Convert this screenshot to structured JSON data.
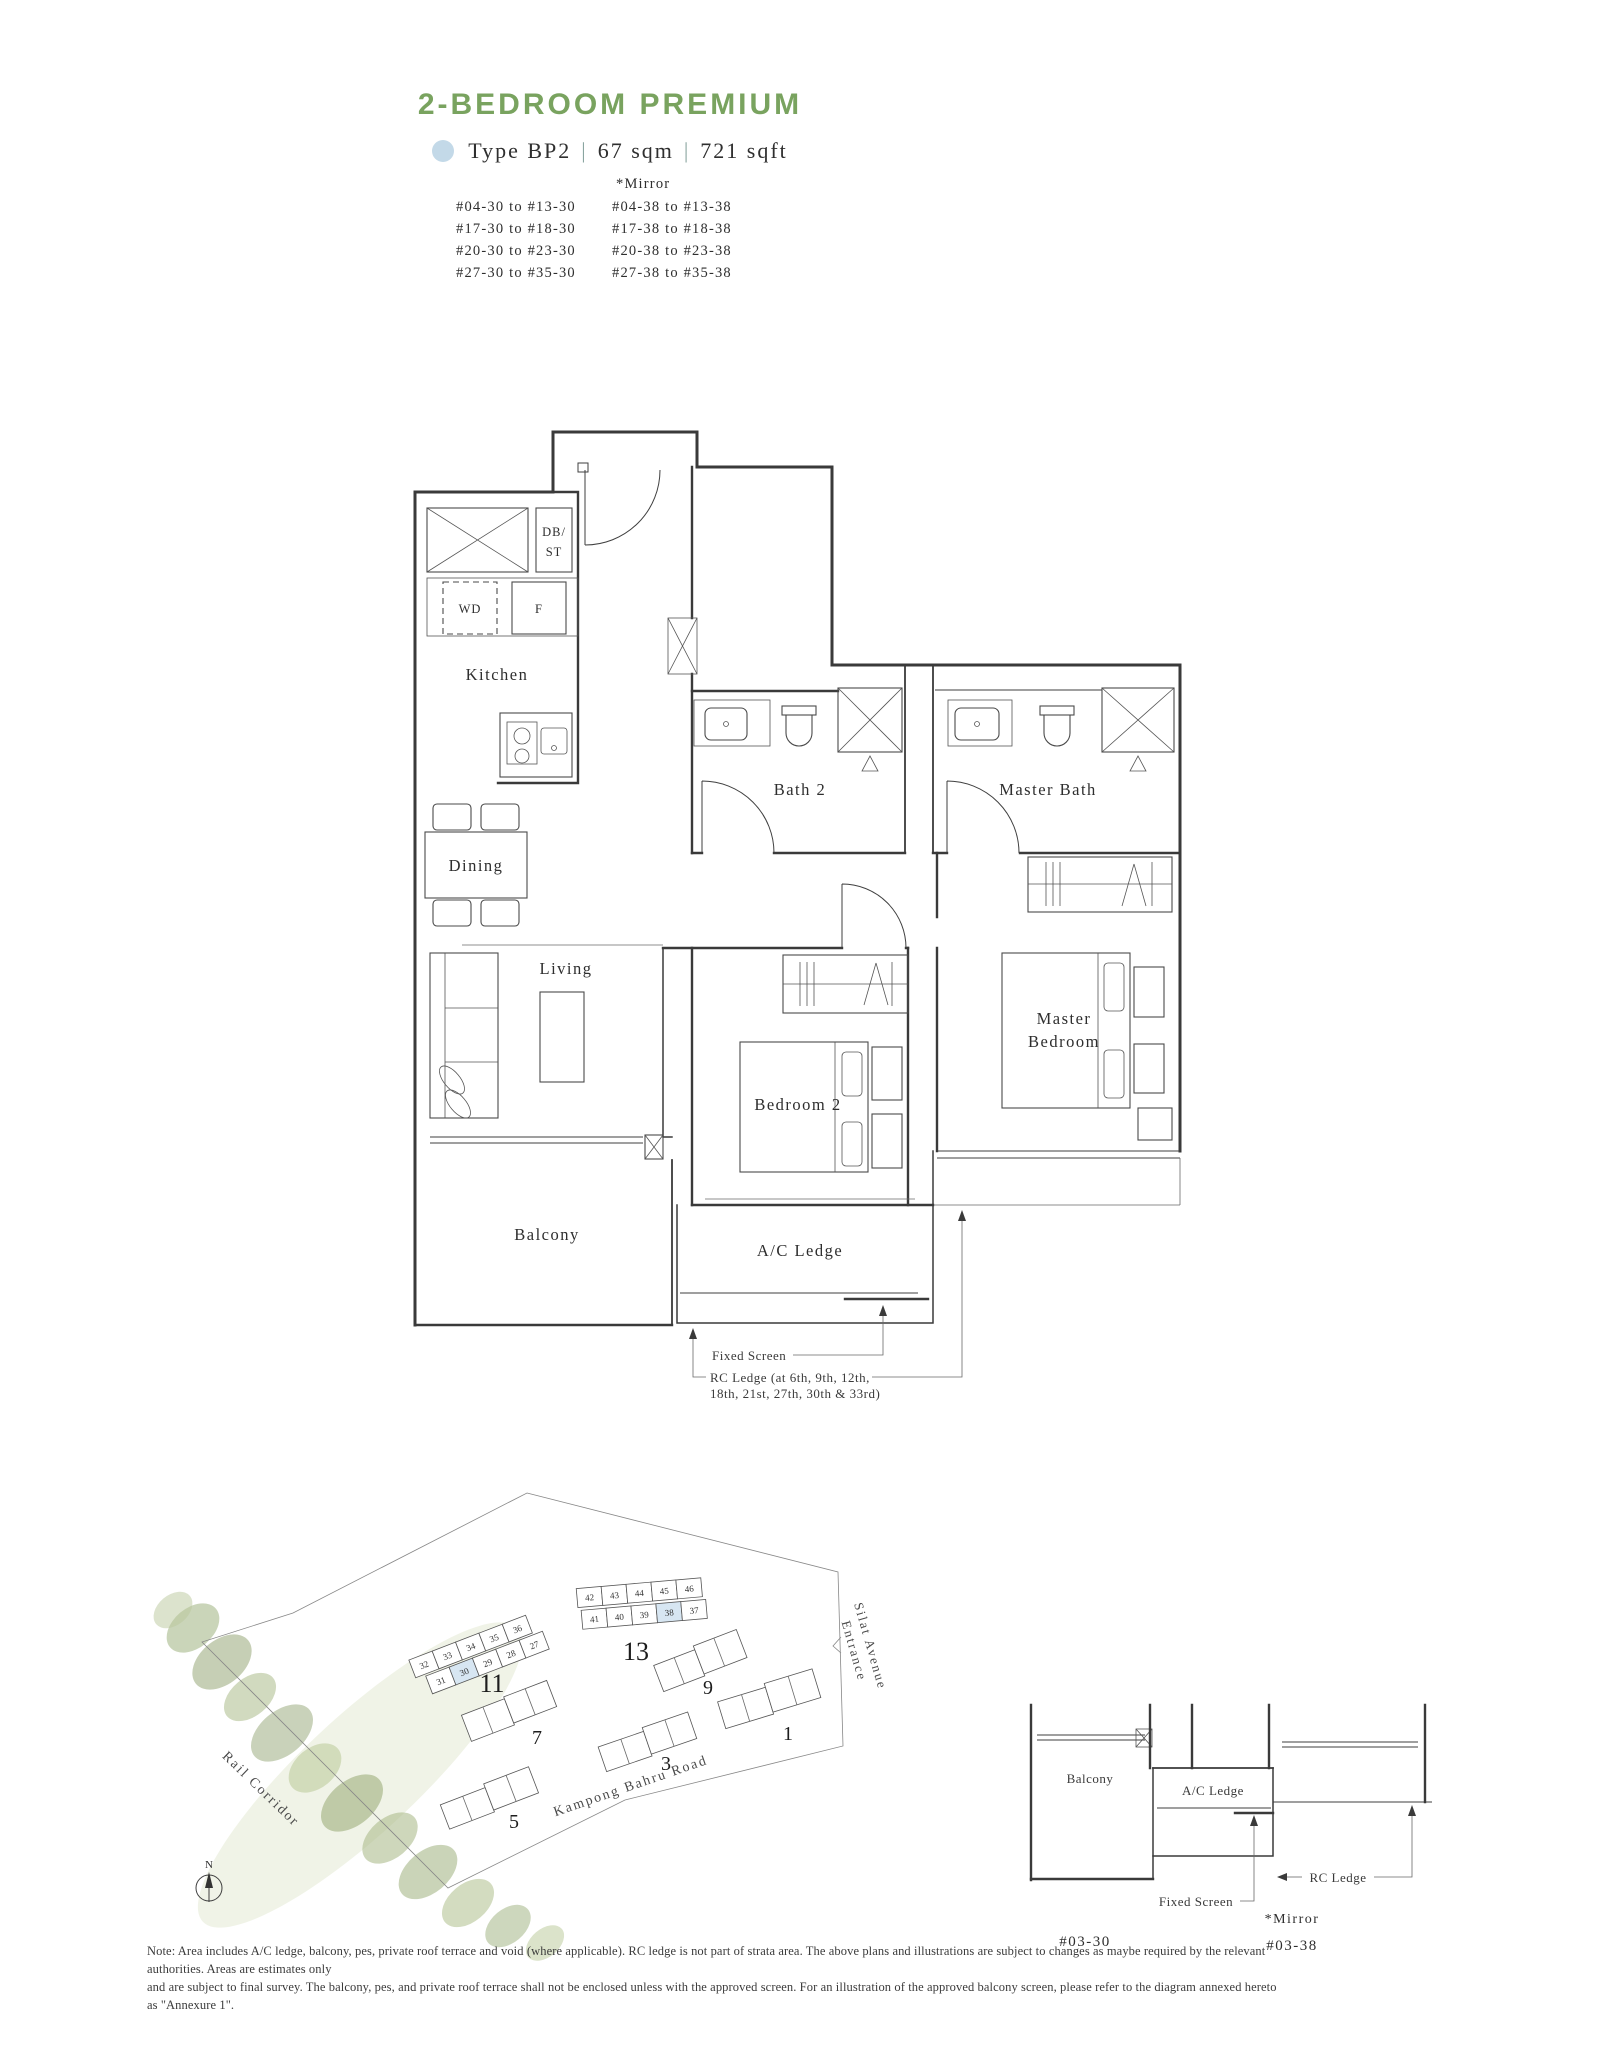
{
  "header": {
    "title": "2-BEDROOM PREMIUM",
    "legend": {
      "type": "Type BP2",
      "sep": "|",
      "sqm": "67 sqm",
      "sqft": "721 sqft"
    }
  },
  "stacks": {
    "mirror_header": "*Mirror",
    "left": [
      "#04-30 to #13-30",
      "#17-30 to #18-30",
      "#20-30 to #23-30",
      "#27-30 to #35-30"
    ],
    "right": [
      "#04-38 to #13-38",
      "#17-38 to #18-38",
      "#20-38 to #23-38",
      "#27-38 to #35-38"
    ]
  },
  "floorplan": {
    "rooms": {
      "kitchen": "Kitchen",
      "dining": "Dining",
      "living": "Living",
      "bath2": "Bath 2",
      "master_bath": "Master Bath",
      "bedroom2": "Bedroom 2",
      "master_bedroom_line1": "Master",
      "master_bedroom_line2": "Bedroom",
      "balcony": "Balcony",
      "ac_ledge": "A/C Ledge"
    },
    "fixtures": {
      "db_st_line1": "DB/",
      "db_st_line2": "ST",
      "wd": "WD",
      "fridge": "F"
    },
    "annotations": {
      "fixed_screen": "Fixed Screen",
      "rc_ledge_line1": "RC Ledge (at 6th, 9th, 12th,",
      "rc_ledge_line2": "18th, 21st, 27th, 30th & 33rd)"
    }
  },
  "siteplan": {
    "labels": {
      "rail_corridor": "Rail Corridor",
      "road": "Kampong Bahru Road",
      "entrance_line1": "Silat Avenue",
      "entrance_line2": "Entrance",
      "north": "N"
    },
    "buildings": {
      "b11": {
        "label": "11",
        "top": [
          "32",
          "33",
          "34",
          "35",
          "36"
        ],
        "bottom": [
          "31",
          "30",
          "29",
          "28",
          "27"
        ],
        "highlighted": "30"
      },
      "b13": {
        "label": "13",
        "top": [
          "42",
          "43",
          "44",
          "45",
          "46"
        ],
        "bottom": [
          "41",
          "40",
          "39",
          "38",
          "37"
        ],
        "highlighted": "38"
      },
      "others": [
        "9",
        "7",
        "5",
        "3",
        "1"
      ]
    }
  },
  "detail": {
    "balcony": "Balcony",
    "ac_ledge": "A/C Ledge",
    "rc_ledge": "RC Ledge",
    "fixed_screen": "Fixed Screen",
    "unit": "#03-30",
    "mirror": "*Mirror",
    "mirror_unit": "#03-38"
  },
  "note": {
    "line1": "Note: Area includes A/C ledge, balcony, pes, private roof terrace and void (where applicable). RC ledge is not part of strata area. The above plans and illustrations are subject to changes as maybe required by the relevant authorities. Areas are estimates only",
    "line2": "and are subject to final survey. The balcony, pes, and private roof terrace shall not be enclosed unless with the approved screen. For an illustration of the approved balcony screen, please refer to the diagram annexed hereto as \"Annexure 1\"."
  }
}
